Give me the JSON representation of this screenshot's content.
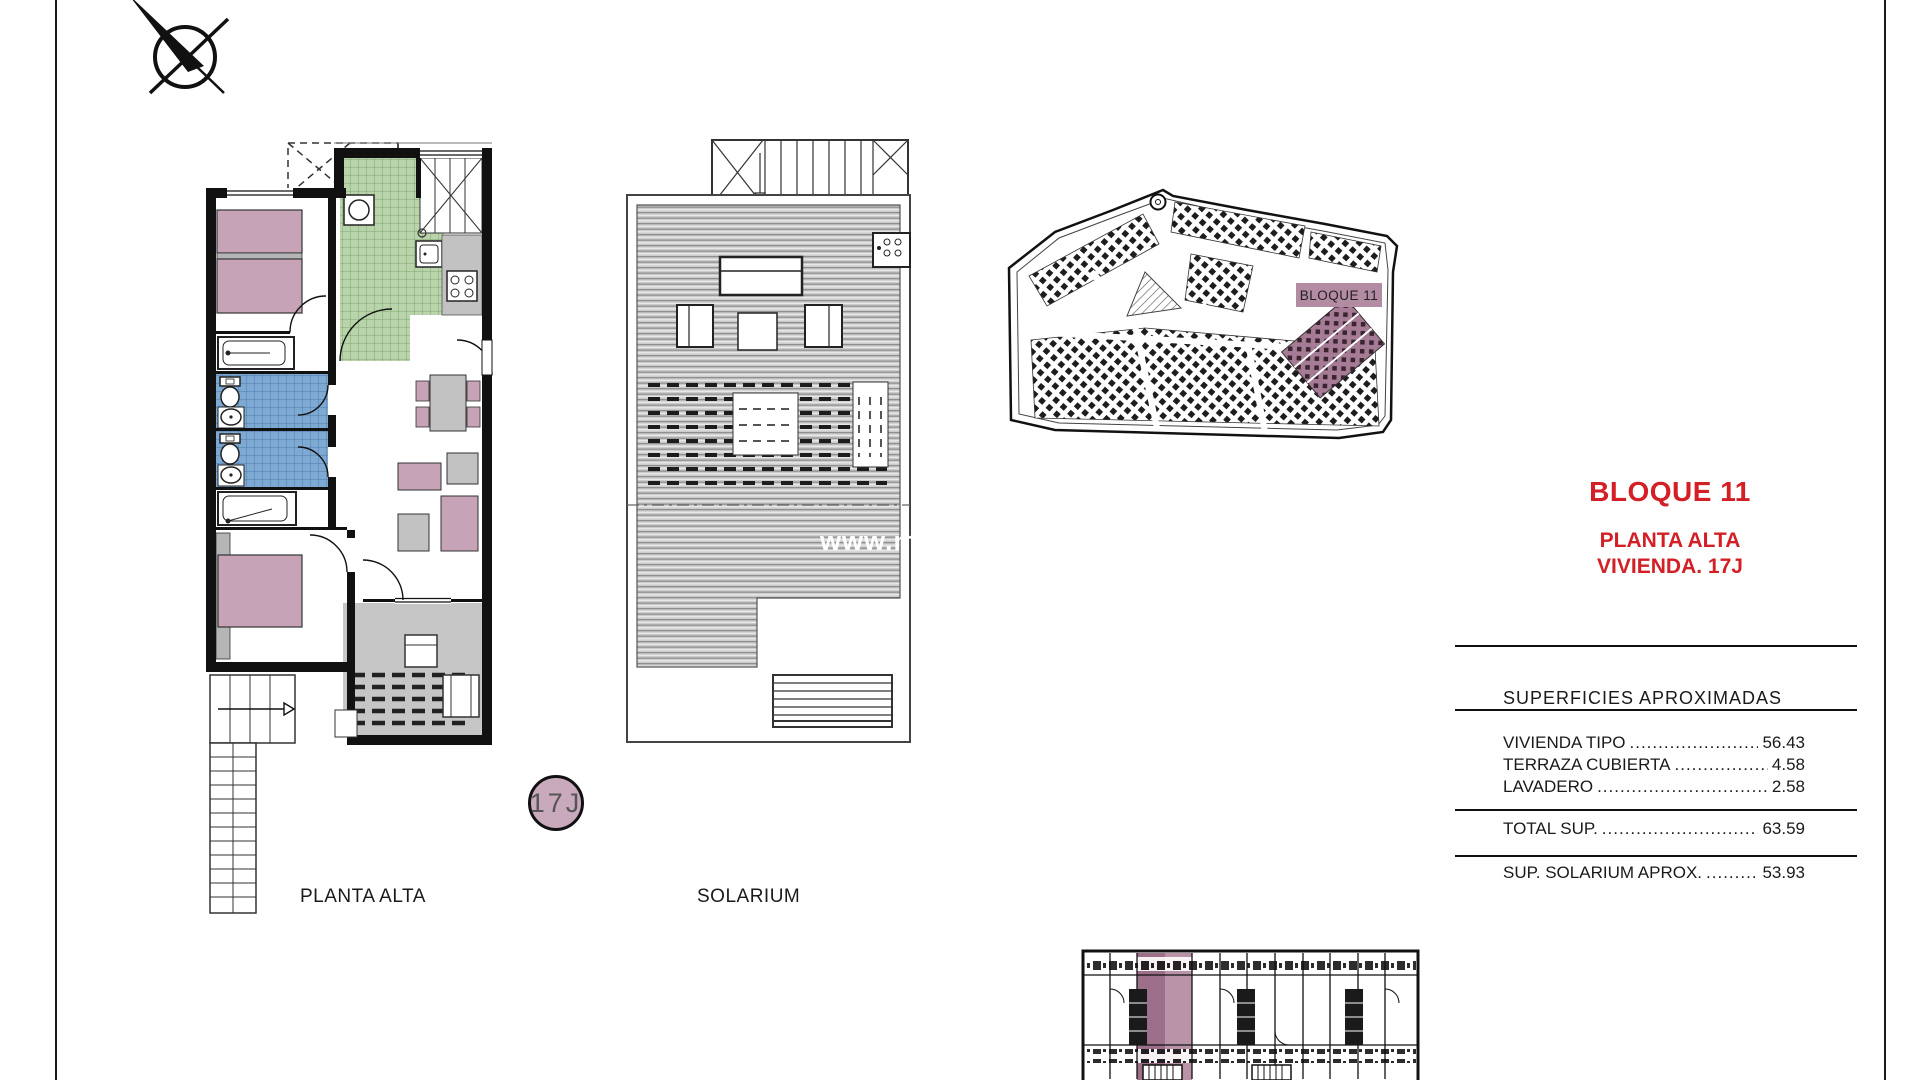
{
  "sheet": {
    "plan_label": "PLANTA ALTA",
    "unit_badge": "17J",
    "solarium_label": "SOLARIUM",
    "watermark": "www.me",
    "site_block_label": "BLOQUE 11"
  },
  "panel": {
    "title": "BLOQUE 11",
    "subtitle1": "PLANTA ALTA",
    "subtitle2": "VIVIENDA. 17J",
    "accent_color": "#d31f26",
    "table_header": "SUPERFICIES APROXIMADAS",
    "rows": [
      {
        "label": "VIVIENDA TIPO",
        "dots": "..........................",
        "value": "56.43"
      },
      {
        "label": "TERRAZA CUBIERTA",
        "dots": "...................",
        "value": "4.58"
      },
      {
        "label": "LAVADERO",
        "dots": "...................................",
        "value": "2.58"
      }
    ],
    "total": {
      "label": "TOTAL SUP.",
      "dots": ".................................",
      "value": "63.59"
    },
    "solarium": {
      "label": "SUP. SOLARIUM APROX.",
      "dots": "..........",
      "value": "53.93"
    }
  }
}
